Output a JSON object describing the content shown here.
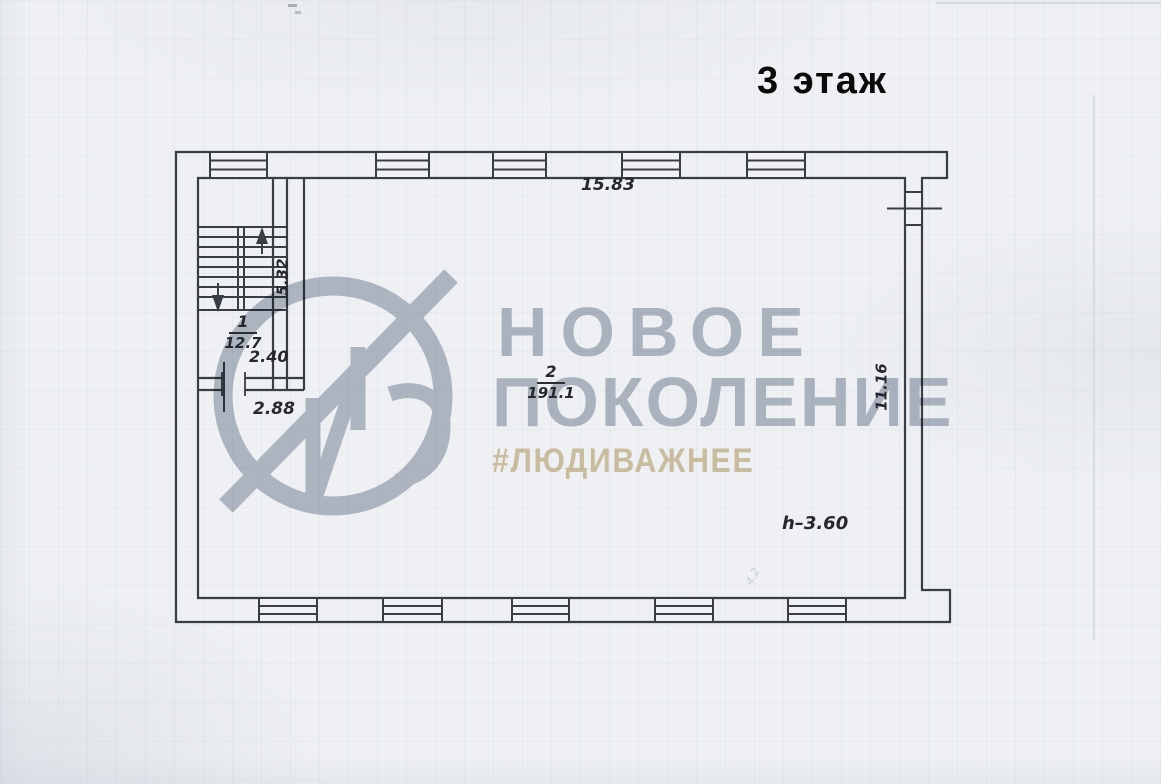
{
  "document": {
    "title": "3 этаж"
  },
  "floor_plan": {
    "rooms": [
      {
        "number": "1",
        "area": "12.7"
      },
      {
        "number": "2",
        "area": "191.1"
      }
    ],
    "dimensions": {
      "top_width": "15.83",
      "stair_flight": "5.32",
      "landing_width": "2.40",
      "doorway_span": "2.88",
      "right_depth": "11.16",
      "ceiling_height": "h–3.60",
      "pencil_note": "4.2"
    }
  },
  "watermark": {
    "brand_line1": "НОВОЕ",
    "brand_line2": "ПОКОЛЕНИЕ",
    "hashtag": "#ЛЮДИВАЖНЕЕ",
    "logo": "ng-monogram-circle"
  },
  "colors": {
    "paper": "#eef0f3",
    "plan_line": "#3a3d43",
    "watermark_gray": "#b1b8c4",
    "hashtag_tan": "#d6c5a0",
    "title_ink": "#0b0b0c"
  }
}
